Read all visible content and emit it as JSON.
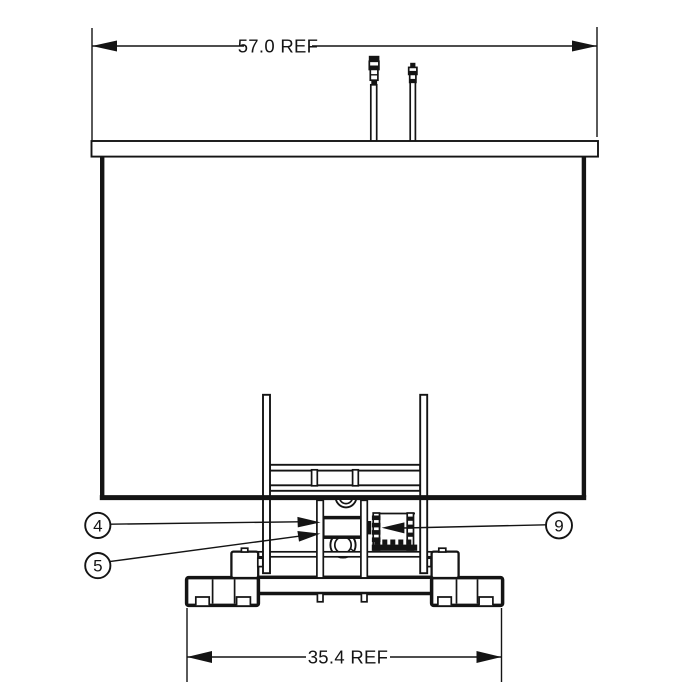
{
  "drawing": {
    "dimensions": {
      "top": "57.0 REF",
      "bottom": "35.4 REF"
    },
    "callouts": [
      {
        "label": "4"
      },
      {
        "label": "5"
      },
      {
        "label": "9"
      }
    ],
    "colors": {
      "line": "#141414",
      "background": "#ffffff"
    }
  }
}
